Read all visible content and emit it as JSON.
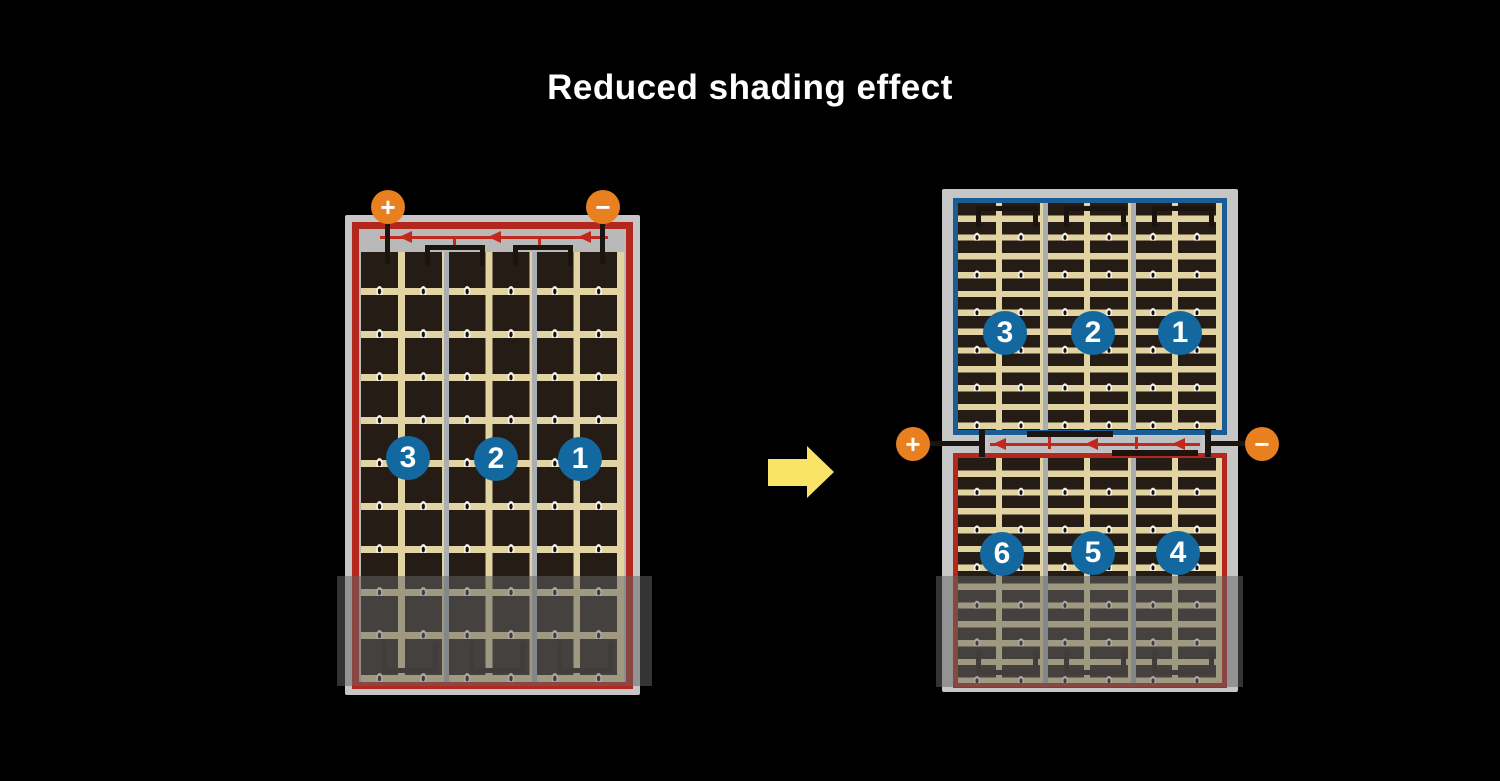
{
  "title": "Reduced shading effect",
  "terminals": {
    "plus": "+",
    "minus": "−"
  },
  "full_panel": {
    "label": "full-cell panel with shading across bottom",
    "badges": [
      "3",
      "2",
      "1"
    ]
  },
  "half_cut_panel": {
    "label": "half-cut panel split into top and bottom halves",
    "top_badges": [
      "3",
      "2",
      "1"
    ],
    "bottom_badges": [
      "6",
      "5",
      "4"
    ]
  },
  "colors": {
    "background": "#000000",
    "accent_orange": "#E8801F",
    "wire_red": "#C2291D",
    "border_red": "#B3271C",
    "border_blue": "#1B5C94",
    "badge_blue": "#1368A0",
    "cell_dark": "#241C15",
    "cell_tan": "#E2D4A2",
    "frame_gray": "#C6C6C6",
    "arrow_yellow": "#F9E468"
  }
}
